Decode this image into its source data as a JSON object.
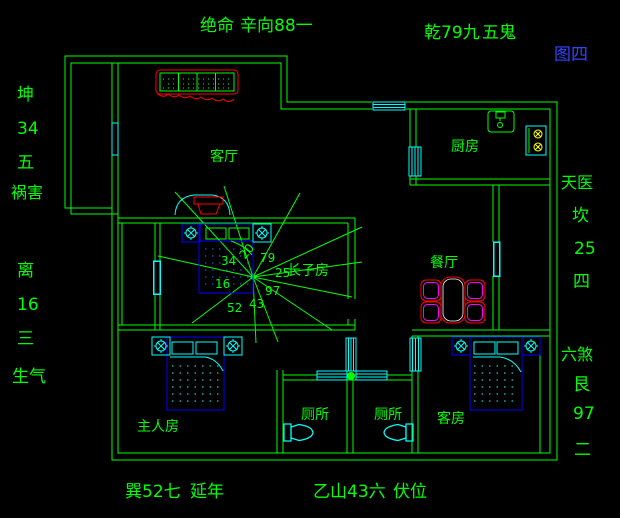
{
  "figure_tag": "图四",
  "compass": {
    "top_left": [
      "绝命",
      "辛向88一"
    ],
    "top_right": [
      "乾79九",
      "五鬼"
    ],
    "left_upper": [
      "坤",
      "34",
      "五",
      "祸害"
    ],
    "left_lower": [
      "离",
      "16",
      "三",
      "生气"
    ],
    "right_upper": [
      "天医",
      "坎",
      "25",
      "四"
    ],
    "right_lower": [
      "六煞",
      "艮",
      "97",
      "二"
    ],
    "bottom_left": [
      "巽52七",
      "延年"
    ],
    "bottom_right": [
      "乙山43六",
      "伏位"
    ]
  },
  "rooms": {
    "living": "客厅",
    "kitchen": "厨房",
    "dining": "餐厅",
    "eldest_son": "长子房",
    "master": "主人房",
    "toilet_a": "厕所",
    "toilet_b": "厕所",
    "guest": "客房"
  },
  "flying_stars": {
    "nw": "34",
    "n": "20",
    "ne": "79",
    "e": "25",
    "w": "16",
    "se": "97",
    "s": "43",
    "sw": "52"
  },
  "colors": {
    "background": "#000000",
    "wall_green": "#00ff00",
    "window_cyan": "#00ffff",
    "bed_blue": "#0000ff",
    "accent_red": "#ff0000",
    "chair_magenta": "#ff00ff",
    "burner_yellow": "#ffff00",
    "figure_tag_blue": "#3344ff"
  }
}
